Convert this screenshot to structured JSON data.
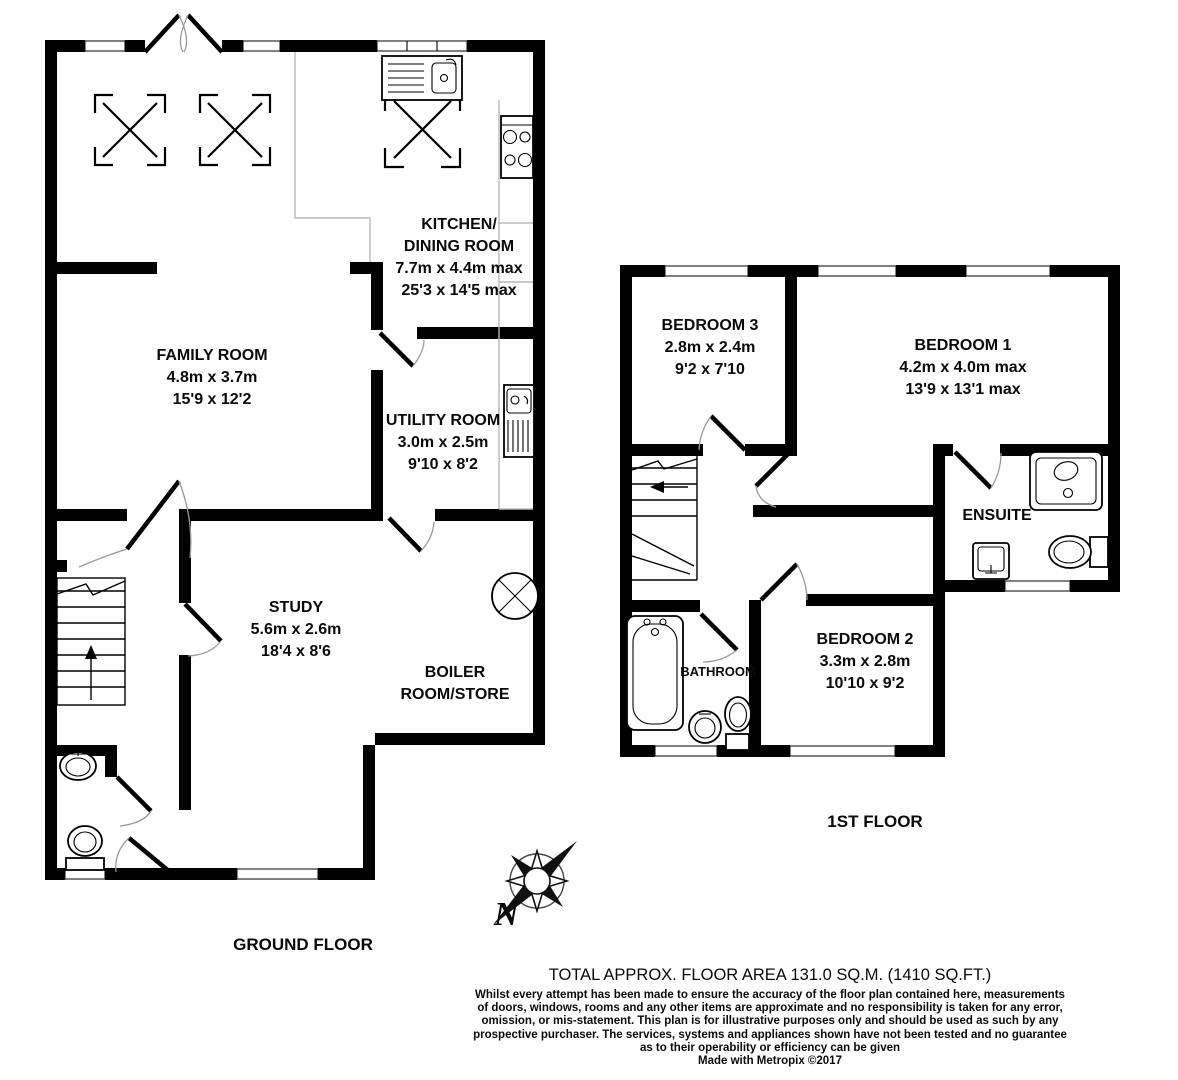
{
  "floorplan": {
    "ground_floor": {
      "title": "GROUND FLOOR",
      "rooms": {
        "kitchen": {
          "name1": "KITCHEN/",
          "name2": "DINING ROOM",
          "metric": "7.7m x 4.4m max",
          "imperial": "25'3 x 14'5 max"
        },
        "family": {
          "name": "FAMILY ROOM",
          "metric": "4.8m x 3.7m",
          "imperial": "15'9 x 12'2"
        },
        "utility": {
          "name": "UTILITY ROOM",
          "metric": "3.0m x 2.5m",
          "imperial": "9'10 x 8'2"
        },
        "study": {
          "name": "STUDY",
          "metric": "5.6m x 2.6m",
          "imperial": "18'4 x 8'6"
        },
        "boiler": {
          "name1": "BOILER",
          "name2": "ROOM/STORE"
        }
      }
    },
    "first_floor": {
      "title": "1ST FLOOR",
      "rooms": {
        "bedroom3": {
          "name": "BEDROOM 3",
          "metric": "2.8m x 2.4m",
          "imperial": "9'2 x 7'10"
        },
        "bedroom1": {
          "name": "BEDROOM 1",
          "metric": "4.2m x 4.0m max",
          "imperial": "13'9 x 13'1 max"
        },
        "bedroom2": {
          "name": "BEDROOM 2",
          "metric": "3.3m x 2.8m",
          "imperial": "10'10 x 9'2"
        },
        "ensuite": {
          "name": "ENSUITE"
        },
        "bathroom": {
          "name": "BATHROOM"
        }
      }
    },
    "compass": {
      "north_label": "N"
    },
    "footer": {
      "total_area": "TOTAL APPROX. FLOOR AREA 131.0 SQ.M. (1410 SQ.FT.)",
      "disclaimer1": "Whilst every attempt has been made to ensure the accuracy of the floor plan contained here, measurements",
      "disclaimer2": "of doors, windows, rooms and any other items are approximate and no responsibility is taken for any error,",
      "disclaimer3": "omission, or mis-statement. This plan is for illustrative purposes only and should be used as such by any",
      "disclaimer4": "prospective purchaser. The services, systems and appliances shown have not been tested and no guarantee",
      "disclaimer5": "as to their operability or efficiency can be given",
      "credit": "Made with Metropix ©2017"
    },
    "colors": {
      "wall": "#000000",
      "counter_line": "#b8b8b8",
      "background": "#ffffff"
    }
  }
}
